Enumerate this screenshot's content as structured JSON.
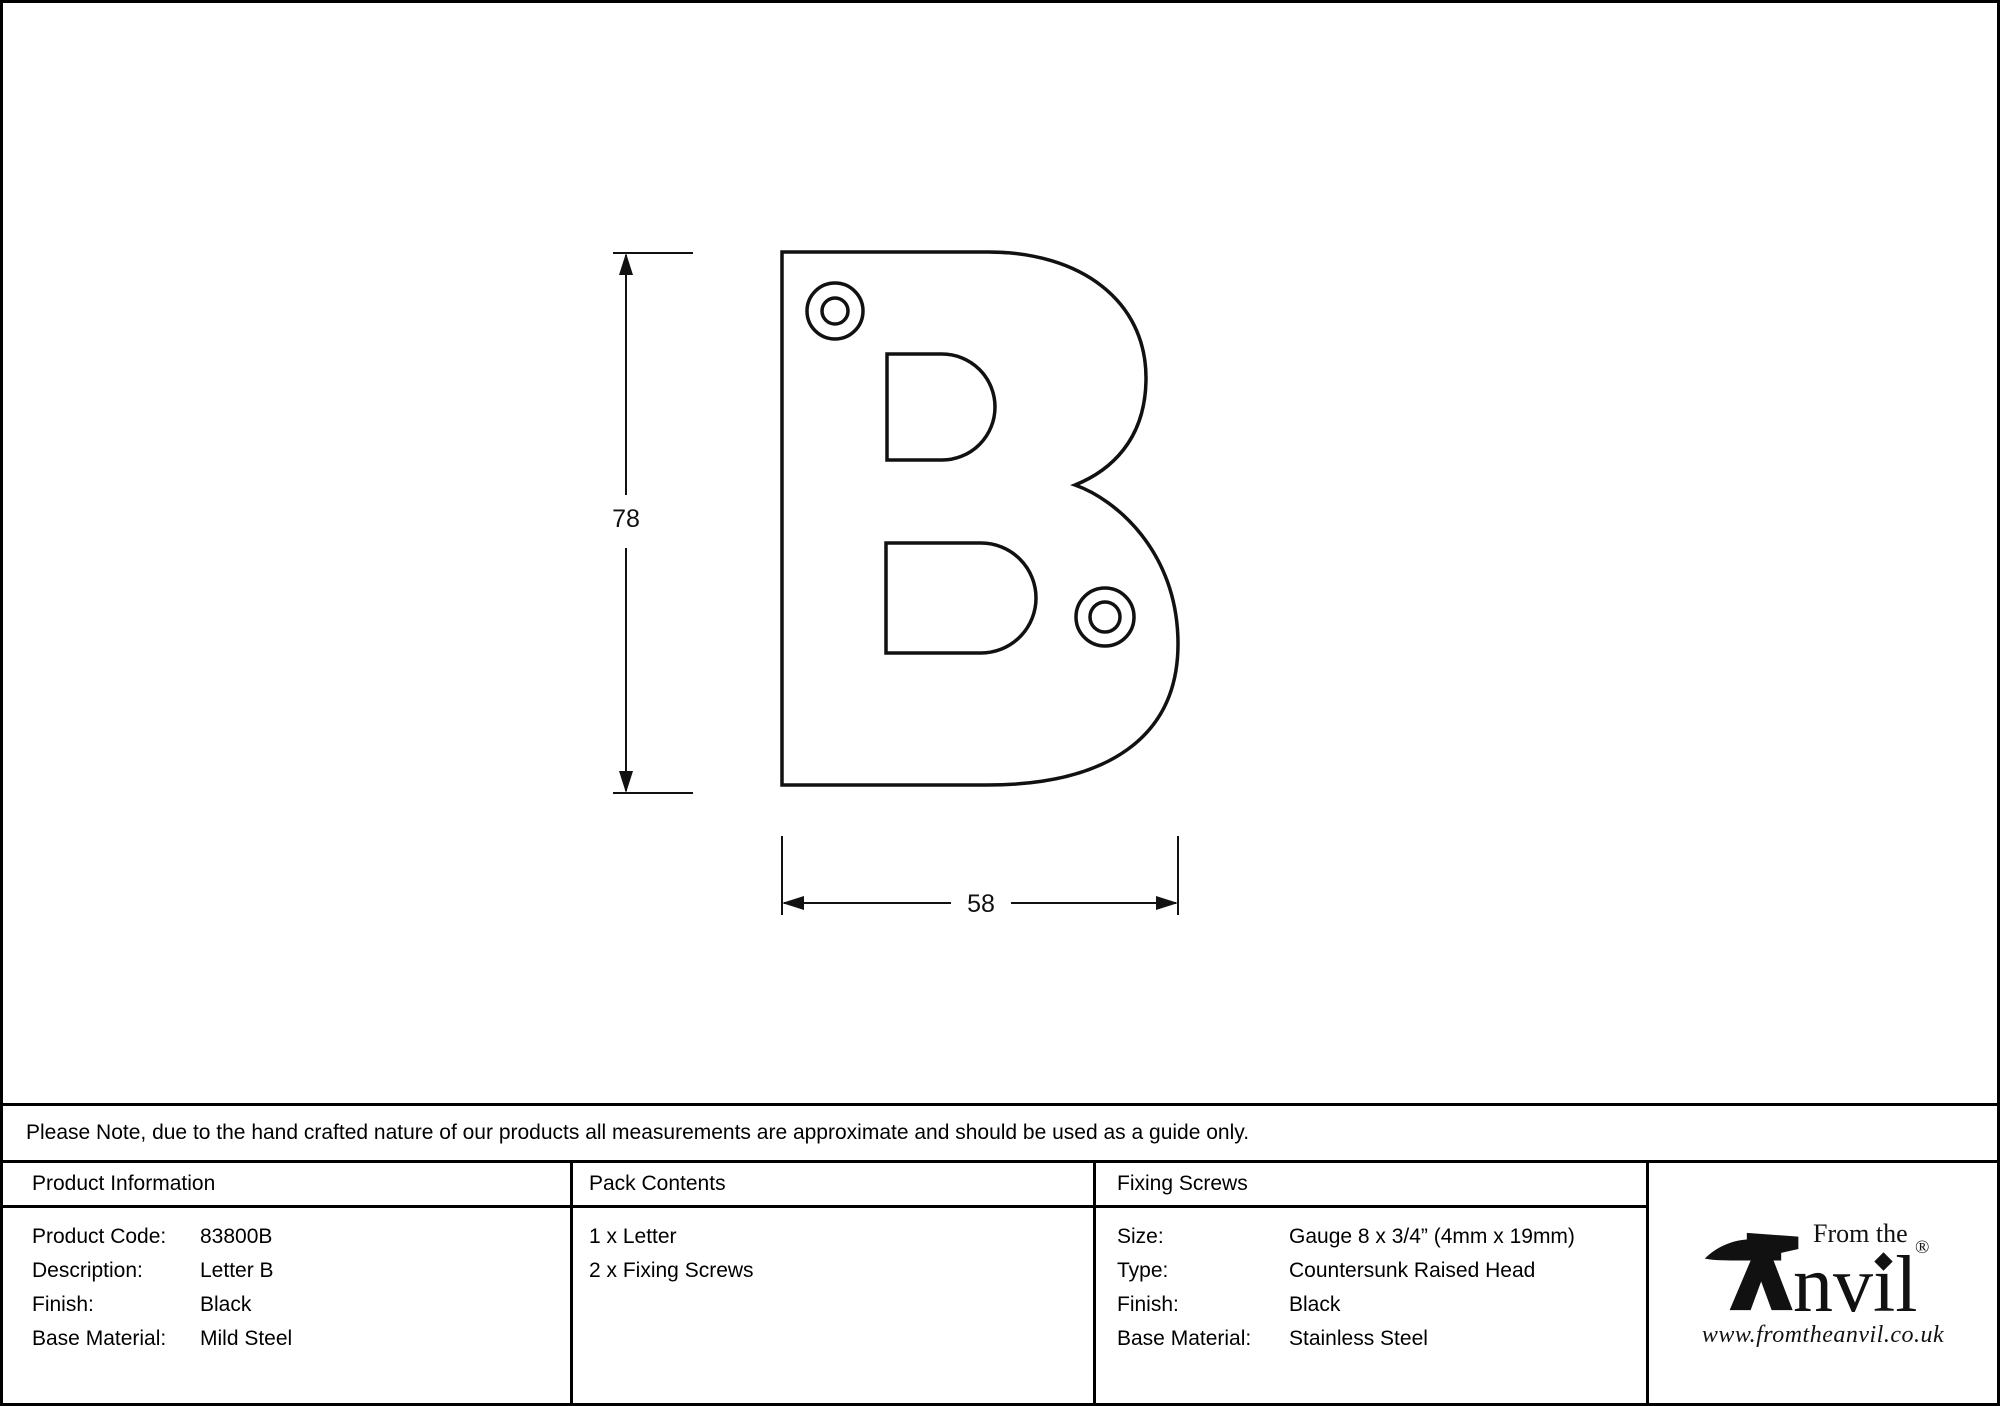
{
  "drawing": {
    "letter": "B",
    "height_dimension": "78",
    "width_dimension": "58"
  },
  "note": "Please Note, due to the hand crafted nature of our products all measurements are approximate and should be used as a guide only.",
  "product_information": {
    "header": "Product Information",
    "rows": [
      {
        "label": "Product Code:",
        "value": "83800B"
      },
      {
        "label": "Description:",
        "value": "Letter B"
      },
      {
        "label": "Finish:",
        "value": "Black"
      },
      {
        "label": "Base Material:",
        "value": "Mild Steel"
      }
    ]
  },
  "pack_contents": {
    "header": "Pack Contents",
    "items": [
      "1 x Letter",
      "2 x Fixing Screws"
    ]
  },
  "fixing_screws": {
    "header": "Fixing Screws",
    "rows": [
      {
        "label": "Size:",
        "value": "Gauge 8 x 3/4” (4mm x 19mm)"
      },
      {
        "label": "Type:",
        "value": "Countersunk Raised Head"
      },
      {
        "label": "Finish:",
        "value": "Black"
      },
      {
        "label": "Base Material:",
        "value": "Stainless Steel"
      }
    ]
  },
  "brand": {
    "prefix": "From the",
    "name_rest": "nvil",
    "registered": "®",
    "website": "www.fromtheanvil.co.uk"
  },
  "colors": {
    "ink": "#111111",
    "background": "#ffffff"
  }
}
